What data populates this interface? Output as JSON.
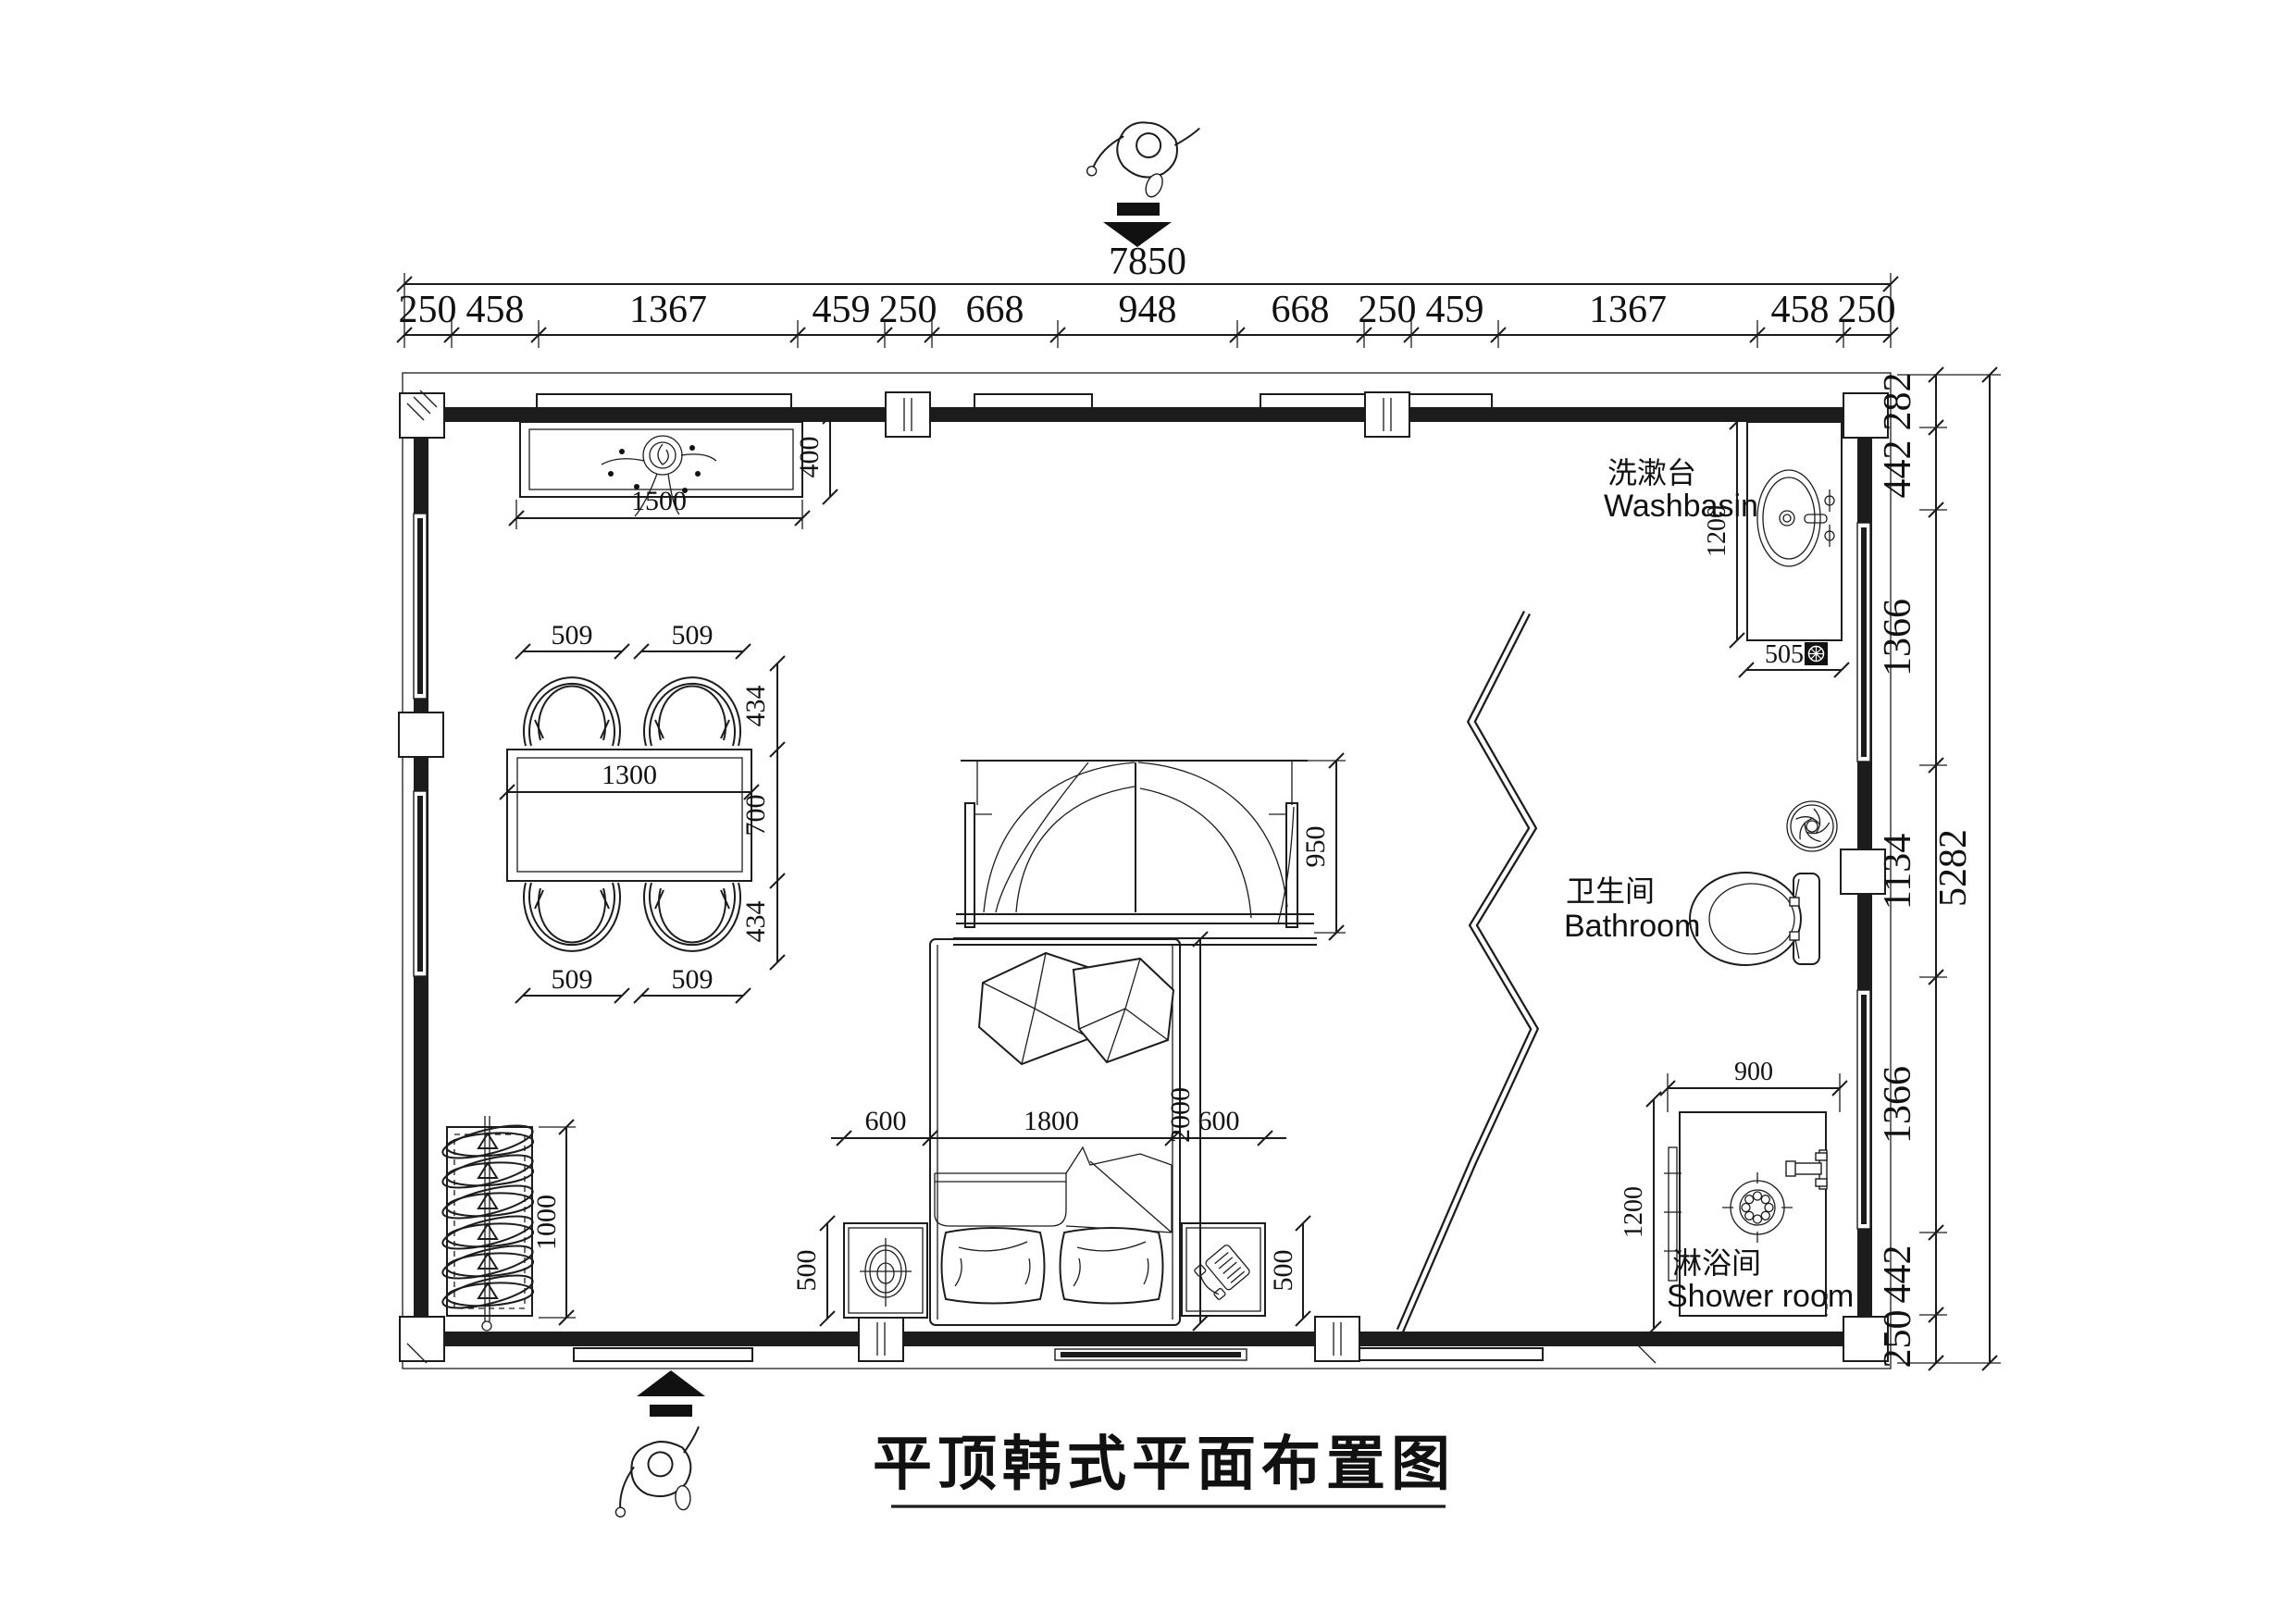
{
  "title": "平顶韩式平面布置图",
  "dimensions": {
    "total_width": "7850",
    "top_segments": [
      "250",
      "458",
      "1367",
      "459",
      "250",
      "668",
      "948",
      "668",
      "250",
      "459",
      "1367",
      "458",
      "250"
    ],
    "total_height": "5282",
    "right_segments": [
      "282",
      "442",
      "1366",
      "1134",
      "1366",
      "442",
      "250"
    ],
    "cabinet": {
      "width": "1500",
      "depth": "400"
    },
    "dining": {
      "chair_width": "509",
      "chair_depth": "434",
      "table_width": "1300",
      "table_depth": "700"
    },
    "wardrobe": {
      "length": "1000"
    },
    "bed": {
      "width": "1800",
      "length": "2000",
      "canopy_depth": "950"
    },
    "nightstand": {
      "width": "600",
      "depth": "500"
    },
    "washbasin": {
      "counter_length": "1200",
      "counter_width": "505"
    },
    "shower": {
      "width": "900",
      "depth": "1200"
    }
  },
  "labels": {
    "washbasin_zh": "洗漱台",
    "washbasin_en": "Washbasin",
    "bathroom_zh": "卫生间",
    "bathroom_en": "Bathroom",
    "shower_zh": "淋浴间",
    "shower_en": "Shower room"
  }
}
